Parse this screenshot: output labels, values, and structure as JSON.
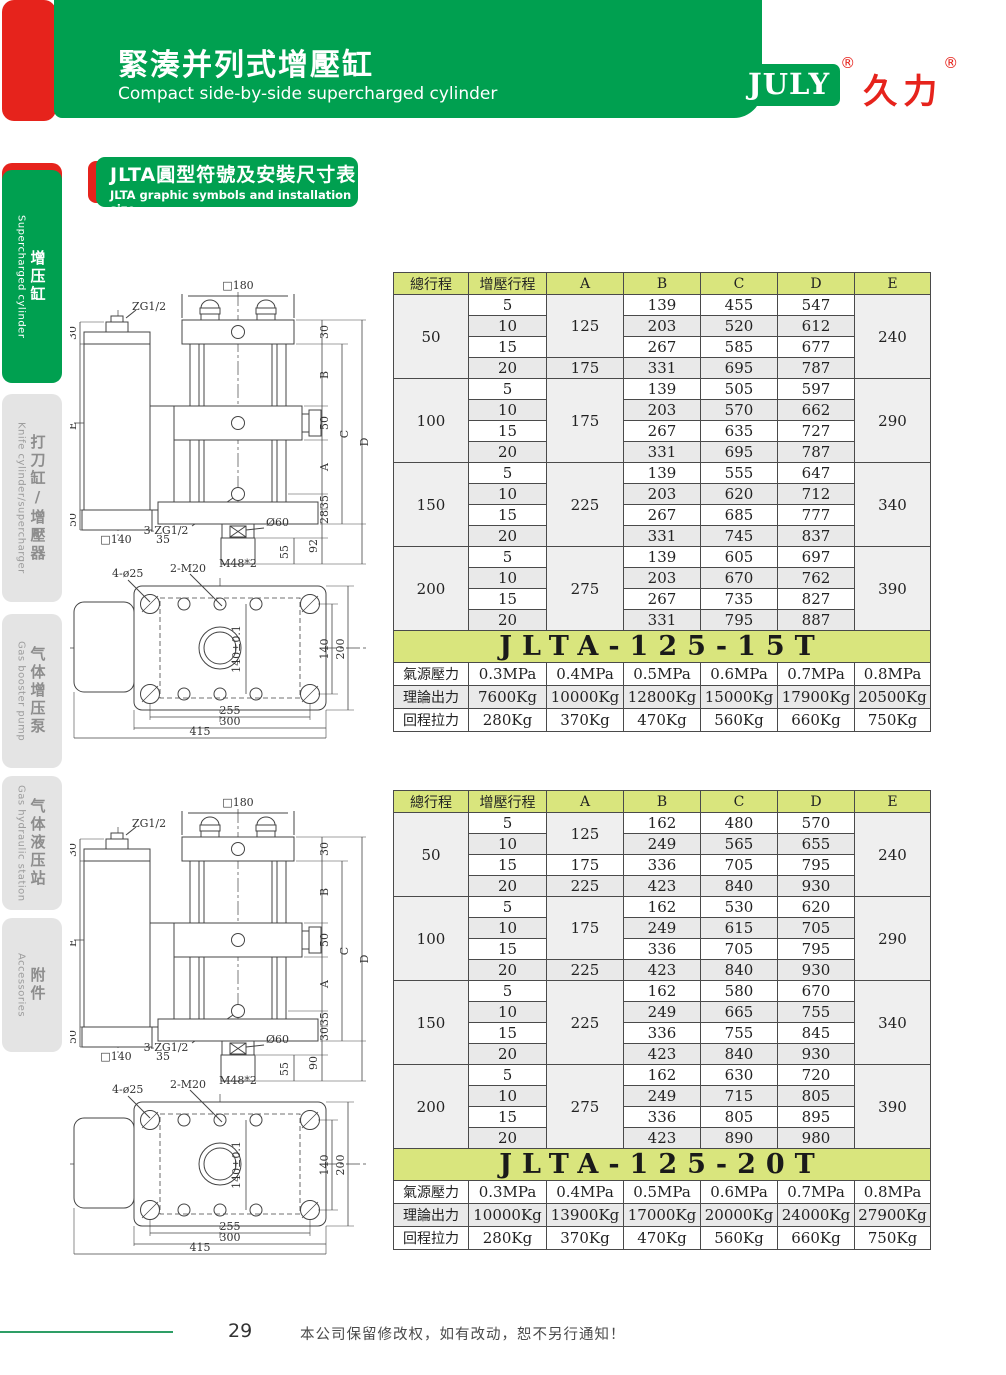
{
  "colors": {
    "brand_green": "#00A050",
    "brand_red": "#E6231C",
    "table_band": "#D9E57D",
    "row_alt": "#E9E9E9"
  },
  "header": {
    "title_zh": "緊湊并列式增壓缸",
    "title_en": "Compact side-by-side supercharged cylinder",
    "brand_en": "JULY",
    "brand_zh": "久力",
    "reg": "®"
  },
  "section_badge": {
    "title_zh": "JLTA圓型符號及安裝尺寸表",
    "title_en": "JLTA graphic symbols and installation size"
  },
  "sidebar": {
    "items": [
      {
        "zh": "增压缸",
        "en": "Supercharged cylinder",
        "active": true
      },
      {
        "zh": "打刀缸/增壓器",
        "en": "Knife cylinder/supercharger",
        "active": false
      },
      {
        "zh": "气体增压泵",
        "en": "Gas booster pump",
        "active": false
      },
      {
        "zh": "气体液压站",
        "en": "Gas hydraulic station",
        "active": false
      },
      {
        "zh": "附件",
        "en": "Accessories",
        "active": false
      }
    ]
  },
  "drawings": [
    {
      "labels": {
        "top_width": "□180",
        "port_top": "ZG1/2",
        "left_30": "30",
        "left_e": "E",
        "left_50": "50",
        "tank_w": "□140",
        "tank_35": "35",
        "r_30": "30",
        "r_b": "B",
        "r_50": "50",
        "r_a": "A",
        "r_35": "35",
        "r_x": "28",
        "r_c": "C",
        "r_d": "D",
        "r_rod": "92",
        "r_55": "55",
        "rod_dia": "Ø60",
        "port3": "3-ZG1/2",
        "thread": "M48*2",
        "m20": "2-M20",
        "d25": "4-ø25",
        "c140t": "140±0.1",
        "c140": "140",
        "c200": "200",
        "b255": "255",
        "b300": "300",
        "b415": "415"
      }
    },
    {
      "labels": {
        "top_width": "□180",
        "port_top": "ZG1/2",
        "left_30": "30",
        "left_e": "E",
        "left_50": "50",
        "tank_w": "□140",
        "tank_35": "35",
        "r_30": "30",
        "r_b": "B",
        "r_50": "50",
        "r_a": "A",
        "r_35": "35",
        "r_x": "30",
        "r_c": "C",
        "r_d": "D",
        "r_rod": "90",
        "r_55": "55",
        "rod_dia": "Ø60",
        "port3": "3-ZG1/2",
        "thread": "M48*2",
        "m20": "2-M20",
        "d25": "4-ø25",
        "c140t": "140±0.1",
        "c140": "140",
        "c200": "200",
        "b255": "255",
        "b300": "300",
        "b415": "415"
      }
    }
  ],
  "tables": [
    {
      "model": "JLTA-125-15T",
      "headers": [
        "總行程",
        "增壓行程",
        "A",
        "B",
        "C",
        "D",
        "E"
      ],
      "groups": [
        {
          "total": "50",
          "e": "240",
          "a_cells": [
            {
              "v": "125",
              "span": 3
            },
            {
              "v": "175",
              "span": 1
            }
          ],
          "rows": [
            [
              "5",
              "139",
              "455",
              "547"
            ],
            [
              "10",
              "203",
              "520",
              "612"
            ],
            [
              "15",
              "267",
              "585",
              "677"
            ],
            [
              "20",
              "331",
              "695",
              "787"
            ]
          ]
        },
        {
          "total": "100",
          "e": "290",
          "a_cells": [
            {
              "v": "175",
              "span": 4
            }
          ],
          "rows": [
            [
              "5",
              "139",
              "505",
              "597"
            ],
            [
              "10",
              "203",
              "570",
              "662"
            ],
            [
              "15",
              "267",
              "635",
              "727"
            ],
            [
              "20",
              "331",
              "695",
              "787"
            ]
          ]
        },
        {
          "total": "150",
          "e": "340",
          "a_cells": [
            {
              "v": "225",
              "span": 4
            }
          ],
          "rows": [
            [
              "5",
              "139",
              "555",
              "647"
            ],
            [
              "10",
              "203",
              "620",
              "712"
            ],
            [
              "15",
              "267",
              "685",
              "777"
            ],
            [
              "20",
              "331",
              "745",
              "837"
            ]
          ]
        },
        {
          "total": "200",
          "e": "390",
          "a_cells": [
            {
              "v": "275",
              "span": 4
            }
          ],
          "rows": [
            [
              "5",
              "139",
              "605",
              "697"
            ],
            [
              "10",
              "203",
              "670",
              "762"
            ],
            [
              "15",
              "267",
              "735",
              "827"
            ],
            [
              "20",
              "331",
              "795",
              "887"
            ]
          ]
        }
      ],
      "specs": [
        {
          "label": "氣源壓力",
          "values": [
            "0.3MPa",
            "0.4MPa",
            "0.5MPa",
            "0.6MPa",
            "0.7MPa",
            "0.8MPa"
          ]
        },
        {
          "label": "理論出力",
          "values": [
            "7600Kg",
            "10000Kg",
            "12800Kg",
            "15000Kg",
            "17900Kg",
            "20500Kg"
          ]
        },
        {
          "label": "回程拉力",
          "values": [
            "280Kg",
            "370Kg",
            "470Kg",
            "560Kg",
            "660Kg",
            "750Kg"
          ]
        }
      ]
    },
    {
      "model": "JLTA-125-20T",
      "headers": [
        "總行程",
        "增壓行程",
        "A",
        "B",
        "C",
        "D",
        "E"
      ],
      "groups": [
        {
          "total": "50",
          "e": "240",
          "a_cells": [
            {
              "v": "125",
              "span": 2
            },
            {
              "v": "175",
              "span": 1
            },
            {
              "v": "225",
              "span": 1
            }
          ],
          "rows": [
            [
              "5",
              "162",
              "480",
              "570"
            ],
            [
              "10",
              "249",
              "565",
              "655"
            ],
            [
              "15",
              "336",
              "705",
              "795"
            ],
            [
              "20",
              "423",
              "840",
              "930"
            ]
          ]
        },
        {
          "total": "100",
          "e": "290",
          "a_cells": [
            {
              "v": "175",
              "span": 3
            },
            {
              "v": "225",
              "span": 1
            }
          ],
          "rows": [
            [
              "5",
              "162",
              "530",
              "620"
            ],
            [
              "10",
              "249",
              "615",
              "705"
            ],
            [
              "15",
              "336",
              "705",
              "795"
            ],
            [
              "20",
              "423",
              "840",
              "930"
            ]
          ]
        },
        {
          "total": "150",
          "e": "340",
          "a_cells": [
            {
              "v": "225",
              "span": 4
            }
          ],
          "rows": [
            [
              "5",
              "162",
              "580",
              "670"
            ],
            [
              "10",
              "249",
              "665",
              "755"
            ],
            [
              "15",
              "336",
              "755",
              "845"
            ],
            [
              "20",
              "423",
              "840",
              "930"
            ]
          ]
        },
        {
          "total": "200",
          "e": "390",
          "a_cells": [
            {
              "v": "275",
              "span": 4
            }
          ],
          "rows": [
            [
              "5",
              "162",
              "630",
              "720"
            ],
            [
              "10",
              "249",
              "715",
              "805"
            ],
            [
              "15",
              "336",
              "805",
              "895"
            ],
            [
              "20",
              "423",
              "890",
              "980"
            ]
          ]
        }
      ],
      "specs": [
        {
          "label": "氣源壓力",
          "values": [
            "0.3MPa",
            "0.4MPa",
            "0.5MPa",
            "0.6MPa",
            "0.7MPa",
            "0.8MPa"
          ]
        },
        {
          "label": "理論出力",
          "values": [
            "10000Kg",
            "13900Kg",
            "17000Kg",
            "20000Kg",
            "24000Kg",
            "27900Kg"
          ]
        },
        {
          "label": "回程拉力",
          "values": [
            "280Kg",
            "370Kg",
            "470Kg",
            "560Kg",
            "660Kg",
            "750Kg"
          ]
        }
      ]
    }
  ],
  "footer": {
    "page": "29",
    "note": "本公司保留修改权，如有改动，恕不另行通知！"
  }
}
